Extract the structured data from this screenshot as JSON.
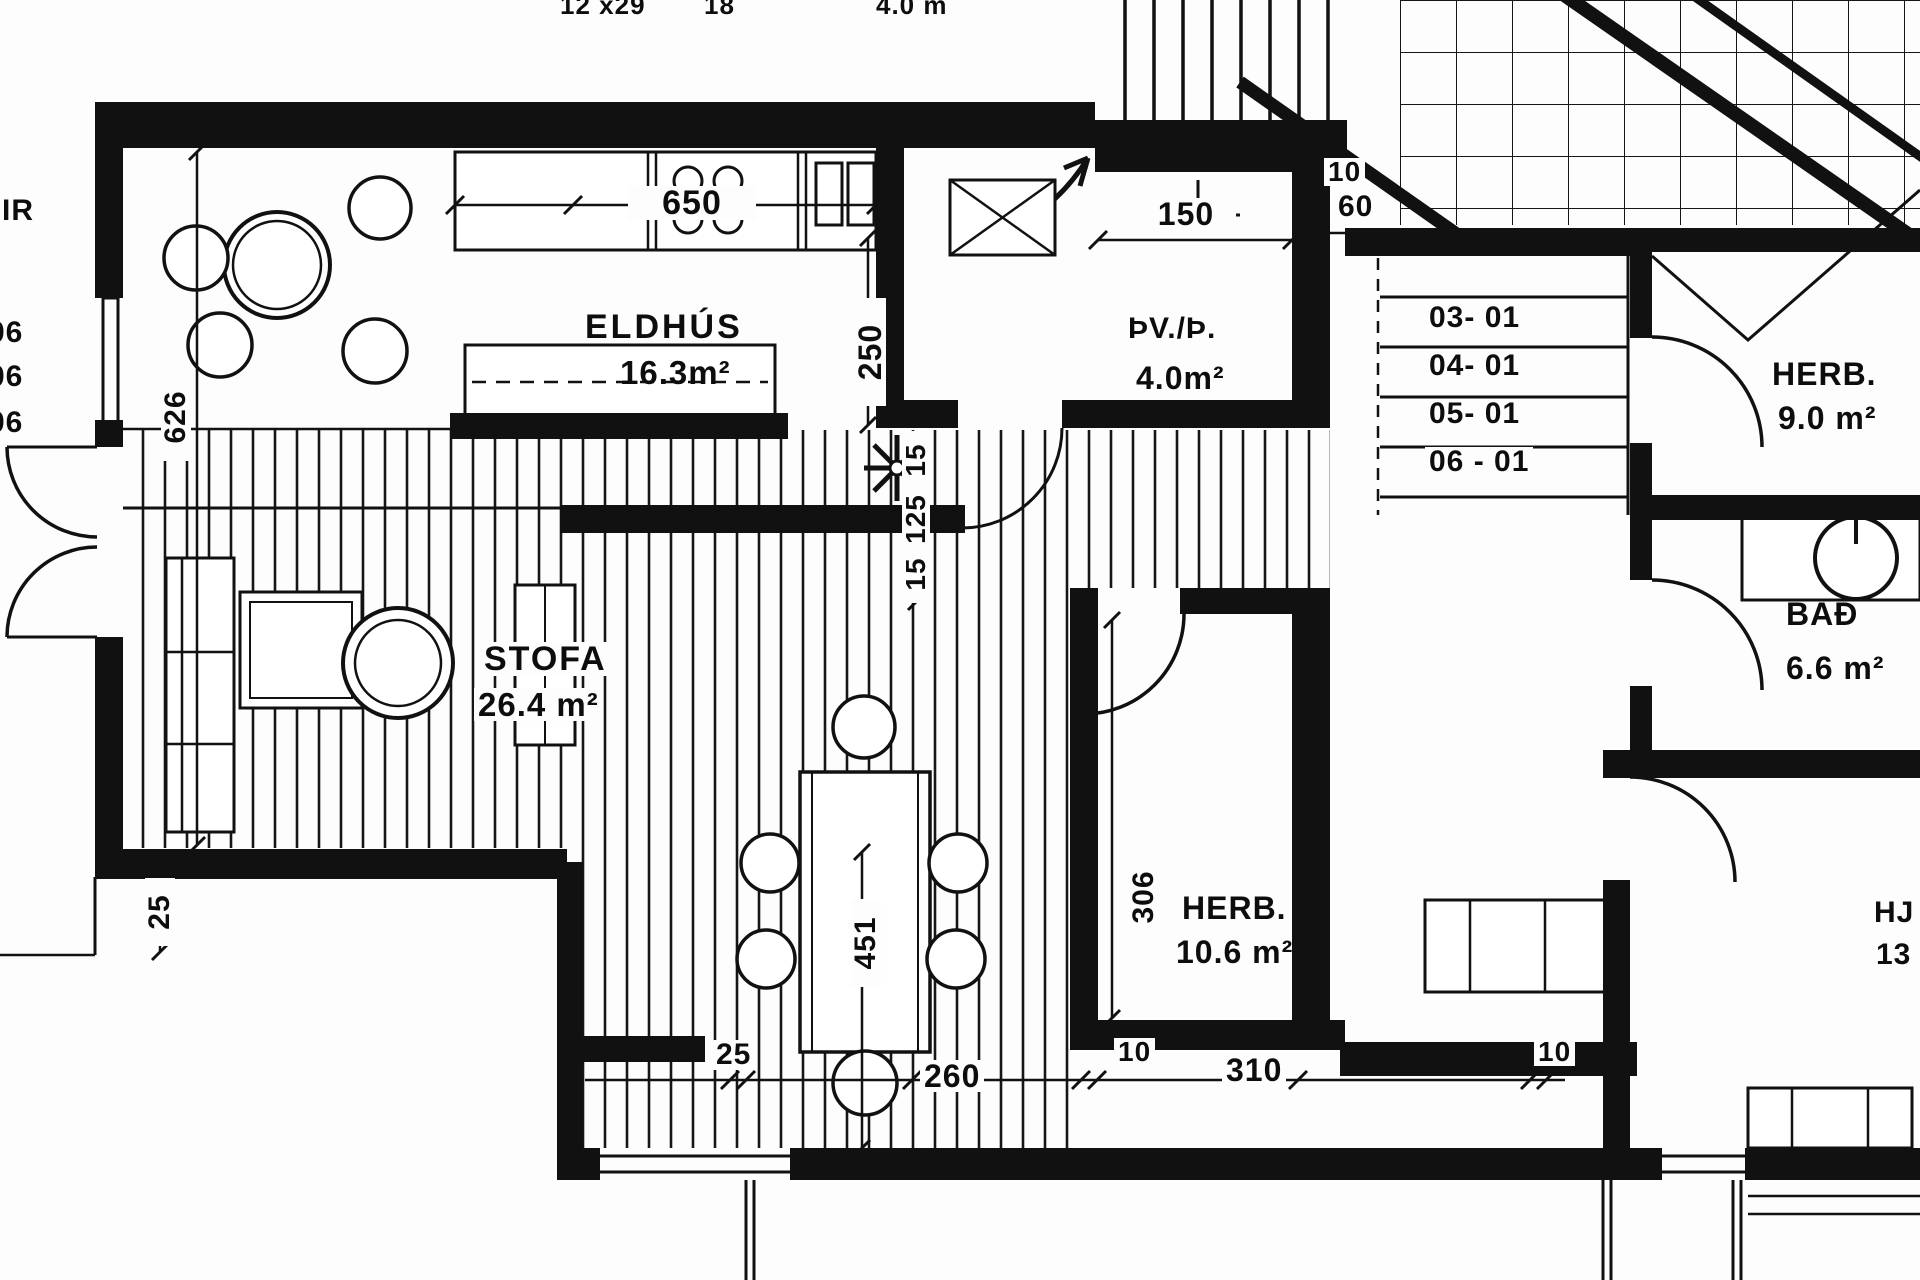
{
  "plan": {
    "title": "apartment-floor-plan",
    "rooms": {
      "kitchen": {
        "name": "ELDHÚS",
        "area": "16.3m²"
      },
      "laundry": {
        "name": "ÞV./Þ.",
        "area": "4.0m²"
      },
      "living": {
        "name": "STOFA",
        "area": "26.4 m²"
      },
      "bedroom1": {
        "name": "HERB.",
        "area": "10.6 m²"
      },
      "bedroom2": {
        "name": "HERB.",
        "area": "9.0 m²"
      },
      "bath": {
        "name": "BAÐ",
        "area": "6.6 m²"
      }
    },
    "stairs": {
      "levels": [
        "03- 01",
        "04- 01",
        "05- 01",
        "06 - 01"
      ],
      "width_dim": "10",
      "run_dim": "60"
    },
    "dims": {
      "kitchen_counter": "650",
      "laundry": "150",
      "kitchen_depth": "250",
      "left_height": "626",
      "hall_chain": [
        "15",
        "125",
        "15"
      ],
      "dining_length": "451",
      "bedroom_depth": "306",
      "bottom_chain": [
        "25",
        "260",
        "10",
        "310",
        "10"
      ],
      "terrace_side": "25"
    },
    "fragments": {
      "top": [
        "12 x29",
        "18",
        "4.0 m"
      ],
      "left": [
        "IR",
        "06",
        "06",
        "06"
      ],
      "right": [
        "HJ",
        "13"
      ]
    }
  }
}
